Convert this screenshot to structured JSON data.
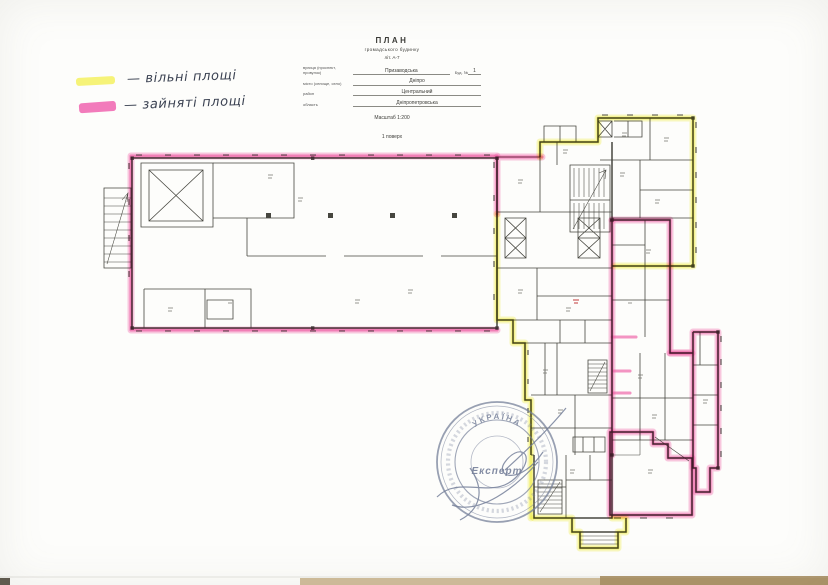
{
  "legend": {
    "items": [
      {
        "swatch_color": "#f5f160",
        "label": "— вільні площі"
      },
      {
        "swatch_color": "#f16db4",
        "label": "— зайняті площі"
      }
    ]
  },
  "title_block": {
    "title": "ПЛАН",
    "subtitle": "громадського будинку",
    "designation": "літ. А-7",
    "fields": [
      {
        "label": "вулиця (проспект, провулок)",
        "value": "Призаводська",
        "right_label": "Буд. №",
        "right_value": "1"
      },
      {
        "label": "місто (селище, село)",
        "value": "Дніпро"
      },
      {
        "label": "район",
        "value": "Центральний"
      },
      {
        "label": "область",
        "value": "Дніпропетровська"
      }
    ],
    "scale_note": "Масштаб 1:200",
    "floor_note": "1 поверх"
  },
  "plan": {
    "wall_color": "#46463f",
    "highlight_free_color": "#f0ec3c",
    "highlight_occupied_color": "#ef54a2"
  },
  "stamp": {
    "arc_text": "УКРАЇНА",
    "center_text": "Експерт",
    "ink_color": "#76809a"
  }
}
